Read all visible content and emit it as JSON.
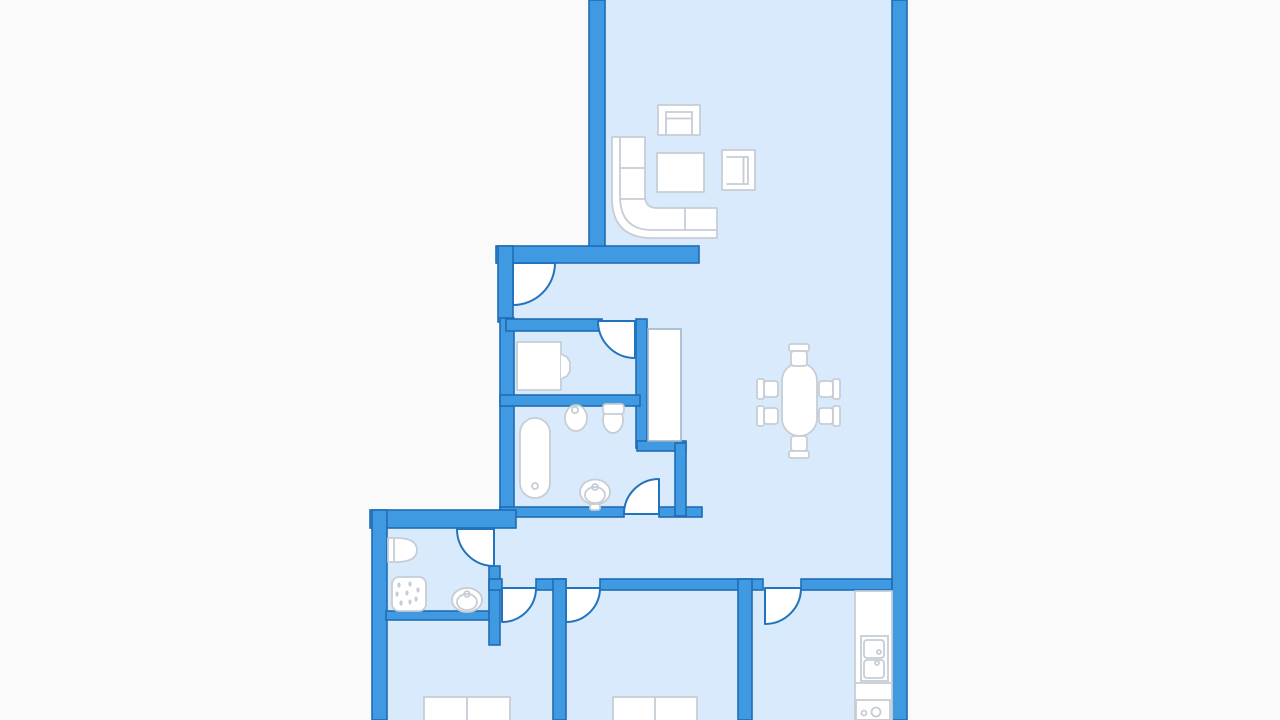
{
  "canvas": {
    "width": 1280,
    "height": 720
  },
  "colors": {
    "background": "#fafafa",
    "wall_fill": "#3f9ae2",
    "wall_stroke": "#1f6cb4",
    "door_stroke": "#2273bd",
    "floor": "#d8eafb",
    "furniture_fill": "#ffffff",
    "furniture_stroke": "#c6cdd5",
    "wardrobe_stroke": "#9db5c9"
  },
  "floors": [
    {
      "name": "living-dining-floor",
      "x": 602,
      "y": 0,
      "w": 292,
      "h": 588
    },
    {
      "name": "hall-bathroom-floor",
      "x": 505,
      "y": 250,
      "w": 150,
      "h": 338
    },
    {
      "name": "bedrooms-kitchen-floor",
      "x": 376,
      "y": 513,
      "w": 522,
      "h": 207
    }
  ],
  "walls": [
    {
      "name": "living-room-west-wall",
      "x": 589,
      "y": 0,
      "w": 16,
      "h": 262
    },
    {
      "name": "entry-north-wall",
      "x": 496,
      "y": 246,
      "w": 203,
      "h": 17
    },
    {
      "name": "entry-west-wall",
      "x": 498,
      "y": 246,
      "w": 15,
      "h": 76
    },
    {
      "name": "study-west-wall",
      "x": 500,
      "y": 318,
      "w": 14,
      "h": 194
    },
    {
      "name": "study-north-wall",
      "x": 506,
      "y": 319,
      "w": 96,
      "h": 12
    },
    {
      "name": "closet-west-wall",
      "x": 636,
      "y": 319,
      "w": 11,
      "h": 129
    },
    {
      "name": "study-bathroom-wall",
      "x": 500,
      "y": 395,
      "w": 140,
      "h": 11
    },
    {
      "name": "bathroom-south-wall-west",
      "x": 500,
      "y": 507,
      "w": 124,
      "h": 10
    },
    {
      "name": "bathroom-south-wall-east",
      "x": 659,
      "y": 507,
      "w": 43,
      "h": 10
    },
    {
      "name": "closet-south-wall",
      "x": 637,
      "y": 441,
      "w": 49,
      "h": 10
    },
    {
      "name": "closet-east-wall",
      "x": 675,
      "y": 443,
      "w": 11,
      "h": 73
    },
    {
      "name": "northwest-exterior-wall",
      "x": 370,
      "y": 510,
      "w": 146,
      "h": 18
    },
    {
      "name": "west-exterior-wall",
      "x": 372,
      "y": 510,
      "w": 15,
      "h": 210
    },
    {
      "name": "shower-room-south-wall",
      "x": 386,
      "y": 611,
      "w": 111,
      "h": 9
    },
    {
      "name": "shower-room-east-wall",
      "x": 489,
      "y": 566,
      "w": 11,
      "h": 79
    },
    {
      "name": "south-corridor-wall-a",
      "x": 489,
      "y": 579,
      "w": 13,
      "h": 11
    },
    {
      "name": "south-corridor-wall-b",
      "x": 536,
      "y": 579,
      "w": 30,
      "h": 11
    },
    {
      "name": "south-corridor-wall-c",
      "x": 600,
      "y": 579,
      "w": 163,
      "h": 11
    },
    {
      "name": "south-corridor-wall-d",
      "x": 801,
      "y": 579,
      "w": 91,
      "h": 11
    },
    {
      "name": "bedroom-divider-wall",
      "x": 553,
      "y": 579,
      "w": 13,
      "h": 141
    },
    {
      "name": "kitchen-divider-wall",
      "x": 738,
      "y": 579,
      "w": 14,
      "h": 141
    },
    {
      "name": "east-exterior-wall",
      "x": 892,
      "y": 0,
      "w": 15,
      "h": 720
    }
  ],
  "doors": [
    {
      "name": "entrance-door",
      "d": "M513,263 L555,263 A42,42 0 0 1 513,305 Z"
    },
    {
      "name": "study-door",
      "d": "M635,321 L635,358 A37,37 0 0 1 598,321 Z"
    },
    {
      "name": "bathroom-door",
      "d": "M659,514 L659,479 A35,35 0 0 0 624,514 Z"
    },
    {
      "name": "shower-door",
      "d": "M494,529 L494,566 A37,37 0 0 1 457,529 Z"
    },
    {
      "name": "bedroom1-door",
      "d": "M502,588 L536,588 A34,34 0 0 1 502,622 Z"
    },
    {
      "name": "bedroom2-door",
      "d": "M566,588 L600,588 A34,34 0 0 1 566,622 Z"
    },
    {
      "name": "kitchen-door",
      "d": "M765,588 L801,588 A36,36 0 0 1 765,624 Z"
    }
  ],
  "furniture": [
    {
      "name": "built-in-closet",
      "shapes": [
        {
          "k": "rect",
          "x": 648,
          "y": 329,
          "w": 33,
          "h": 112,
          "c": "ward"
        }
      ]
    },
    {
      "name": "armchair-top",
      "shapes": [
        {
          "k": "rect",
          "x": 658,
          "y": 105,
          "w": 42,
          "h": 30
        },
        {
          "k": "path",
          "d": "M666,135 L666,112 L692,112 L692,135",
          "c": "fline"
        },
        {
          "k": "line",
          "x1": 666,
          "y1": 118.5,
          "x2": 692,
          "y2": 118.5,
          "c": "fline"
        }
      ]
    },
    {
      "name": "corner-sofa",
      "shapes": [
        {
          "k": "path",
          "d": "M612,137 L645,137 L645,196 Q645,208 657,208 L717,208 L717,238 L652,238 Q612,238 612,198 Z"
        },
        {
          "k": "path",
          "d": "M620,137 L620,196 Q620,230 652,230 L717,230",
          "c": "fline"
        },
        {
          "k": "line",
          "x1": 620,
          "y1": 168,
          "x2": 645,
          "y2": 168,
          "c": "fline"
        },
        {
          "k": "line",
          "x1": 620,
          "y1": 199,
          "x2": 645,
          "y2": 199,
          "c": "fline"
        },
        {
          "k": "line",
          "x1": 685,
          "y1": 208,
          "x2": 685,
          "y2": 230,
          "c": "fline"
        }
      ]
    },
    {
      "name": "coffee-table",
      "shapes": [
        {
          "k": "rect",
          "x": 657,
          "y": 153,
          "w": 47,
          "h": 39
        }
      ]
    },
    {
      "name": "armchair-side",
      "shapes": [
        {
          "k": "rect",
          "x": 722,
          "y": 150,
          "w": 33,
          "h": 40
        },
        {
          "k": "path",
          "d": "M727,157 L748,157 L748,184 L727,184",
          "c": "fline"
        },
        {
          "k": "line",
          "x1": 743.5,
          "y1": 157,
          "x2": 743.5,
          "y2": 184,
          "c": "fline"
        }
      ]
    },
    {
      "name": "dining-table",
      "shapes": [
        {
          "k": "rect",
          "x": 782,
          "y": 363,
          "w": 35,
          "h": 73,
          "rx": 17.5
        }
      ]
    },
    {
      "name": "dining-chair-north",
      "shapes": [
        {
          "k": "rect",
          "x": 789,
          "y": 344,
          "w": 20,
          "h": 7,
          "rx": 2
        },
        {
          "k": "rect",
          "x": 791,
          "y": 351,
          "w": 16,
          "h": 15,
          "rx": 3
        }
      ]
    },
    {
      "name": "dining-chair-south",
      "shapes": [
        {
          "k": "rect",
          "x": 791,
          "y": 436,
          "w": 16,
          "h": 15,
          "rx": 3
        },
        {
          "k": "rect",
          "x": 789,
          "y": 451,
          "w": 20,
          "h": 7,
          "rx": 2
        }
      ]
    },
    {
      "name": "dining-chair-west-1",
      "shapes": [
        {
          "k": "rect",
          "x": 757,
          "y": 379,
          "w": 7,
          "h": 20,
          "rx": 2
        },
        {
          "k": "rect",
          "x": 764,
          "y": 381,
          "w": 14,
          "h": 16,
          "rx": 3
        }
      ]
    },
    {
      "name": "dining-chair-west-2",
      "shapes": [
        {
          "k": "rect",
          "x": 757,
          "y": 406,
          "w": 7,
          "h": 20,
          "rx": 2
        },
        {
          "k": "rect",
          "x": 764,
          "y": 408,
          "w": 14,
          "h": 16,
          "rx": 3
        }
      ]
    },
    {
      "name": "dining-chair-east-1",
      "shapes": [
        {
          "k": "rect",
          "x": 819,
          "y": 381,
          "w": 14,
          "h": 16,
          "rx": 3
        },
        {
          "k": "rect",
          "x": 833,
          "y": 379,
          "w": 7,
          "h": 20,
          "rx": 2
        }
      ]
    },
    {
      "name": "dining-chair-east-2",
      "shapes": [
        {
          "k": "rect",
          "x": 819,
          "y": 408,
          "w": 14,
          "h": 16,
          "rx": 3
        },
        {
          "k": "rect",
          "x": 833,
          "y": 406,
          "w": 7,
          "h": 20,
          "rx": 2
        }
      ]
    },
    {
      "name": "study-vanity-unit",
      "shapes": [
        {
          "k": "rect",
          "x": 517,
          "y": 342,
          "w": 44,
          "h": 48
        },
        {
          "k": "path",
          "d": "M561,354 L567,357 L570,362 L570,371 L567,376 L561,379"
        }
      ]
    },
    {
      "name": "bathtub",
      "shapes": [
        {
          "k": "rect",
          "x": 520,
          "y": 418,
          "w": 30,
          "h": 80,
          "rx": 15
        },
        {
          "k": "circle",
          "cx": 535,
          "cy": 486,
          "r": 3,
          "c": "fline"
        }
      ]
    },
    {
      "name": "bidet",
      "shapes": [
        {
          "k": "ellipse",
          "cx": 576,
          "cy": 418,
          "rx": 11,
          "ry": 13
        },
        {
          "k": "circle",
          "cx": 575,
          "cy": 410,
          "r": 3.2,
          "c": "fline"
        }
      ]
    },
    {
      "name": "toilet",
      "shapes": [
        {
          "k": "ellipse",
          "cx": 613,
          "cy": 420,
          "rx": 10,
          "ry": 13
        },
        {
          "k": "rect",
          "x": 603,
          "y": 404,
          "w": 21,
          "h": 10,
          "rx": 3
        }
      ]
    },
    {
      "name": "bathroom-washbasin",
      "shapes": [
        {
          "k": "ellipse",
          "cx": 595,
          "cy": 492,
          "rx": 15,
          "ry": 12.5
        },
        {
          "k": "ellipse",
          "cx": 595,
          "cy": 495,
          "rx": 10,
          "ry": 8,
          "c": "fline"
        },
        {
          "k": "circle",
          "cx": 595,
          "cy": 487,
          "r": 3,
          "c": "fline"
        },
        {
          "k": "rect",
          "x": 590,
          "y": 504,
          "w": 10,
          "h": 6,
          "rx": 2
        }
      ]
    },
    {
      "name": "shower-room-washbasin",
      "shapes": [
        {
          "k": "path",
          "d": "M388,538 L396,538 Q417,538 417,550 Q417,562 396,562 L388,562 Z"
        },
        {
          "k": "line",
          "x1": 394,
          "y1": 539,
          "x2": 394,
          "y2": 561,
          "c": "fline"
        }
      ]
    },
    {
      "name": "shower",
      "shapes": [
        {
          "k": "rect",
          "x": 392,
          "y": 577,
          "w": 34,
          "h": 34,
          "rx": 7
        },
        {
          "k": "ellipse",
          "cx": 399,
          "cy": 585,
          "rx": 1.6,
          "ry": 2.6,
          "c": "drop"
        },
        {
          "k": "ellipse",
          "cx": 410,
          "cy": 584,
          "rx": 1.6,
          "ry": 2.6,
          "c": "drop"
        },
        {
          "k": "ellipse",
          "cx": 418,
          "cy": 590,
          "rx": 1.6,
          "ry": 2.6,
          "c": "drop"
        },
        {
          "k": "ellipse",
          "cx": 397,
          "cy": 594,
          "rx": 1.6,
          "ry": 2.6,
          "c": "drop"
        },
        {
          "k": "ellipse",
          "cx": 407,
          "cy": 593,
          "rx": 1.6,
          "ry": 2.6,
          "c": "drop"
        },
        {
          "k": "ellipse",
          "cx": 416,
          "cy": 599,
          "rx": 1.6,
          "ry": 2.6,
          "c": "drop"
        },
        {
          "k": "ellipse",
          "cx": 401,
          "cy": 603,
          "rx": 1.6,
          "ry": 2.6,
          "c": "drop"
        },
        {
          "k": "ellipse",
          "cx": 410,
          "cy": 602,
          "rx": 1.6,
          "ry": 2.6,
          "c": "drop"
        }
      ]
    },
    {
      "name": "shower-room-toilet",
      "shapes": [
        {
          "k": "ellipse",
          "cx": 467,
          "cy": 600,
          "rx": 15,
          "ry": 12
        },
        {
          "k": "ellipse",
          "cx": 467,
          "cy": 602,
          "rx": 10,
          "ry": 8,
          "c": "fline"
        },
        {
          "k": "circle",
          "cx": 467,
          "cy": 594,
          "r": 2.8,
          "c": "fline"
        }
      ]
    },
    {
      "name": "bed-1",
      "shapes": [
        {
          "k": "rect",
          "x": 424,
          "y": 697,
          "w": 86,
          "h": 27
        },
        {
          "k": "line",
          "x1": 467,
          "y1": 697,
          "x2": 467,
          "y2": 724,
          "c": "fline"
        }
      ]
    },
    {
      "name": "bed-2",
      "shapes": [
        {
          "k": "rect",
          "x": 613,
          "y": 697,
          "w": 84,
          "h": 27
        },
        {
          "k": "line",
          "x1": 655,
          "y1": 697,
          "x2": 655,
          "y2": 724,
          "c": "fline"
        }
      ]
    },
    {
      "name": "kitchen-counter",
      "shapes": [
        {
          "k": "rect",
          "x": 855,
          "y": 591,
          "w": 37,
          "h": 129
        },
        {
          "k": "line",
          "x1": 855,
          "y1": 683,
          "x2": 892,
          "y2": 683,
          "c": "fline"
        }
      ]
    },
    {
      "name": "kitchen-sink",
      "shapes": [
        {
          "k": "rect",
          "x": 861,
          "y": 636,
          "w": 27,
          "h": 45,
          "c": "fline"
        },
        {
          "k": "rect",
          "x": 864,
          "y": 640,
          "w": 20,
          "h": 18,
          "rx": 3,
          "c": "fline"
        },
        {
          "k": "rect",
          "x": 864,
          "y": 660,
          "w": 20,
          "h": 18,
          "rx": 3,
          "c": "fline"
        },
        {
          "k": "circle",
          "cx": 879,
          "cy": 652,
          "r": 2,
          "c": "fline"
        },
        {
          "k": "circle",
          "cx": 877,
          "cy": 663,
          "r": 2,
          "c": "fline"
        }
      ]
    },
    {
      "name": "stove",
      "shapes": [
        {
          "k": "rect",
          "x": 856,
          "y": 700,
          "w": 34,
          "h": 20,
          "c": "fline"
        },
        {
          "k": "circle",
          "cx": 864,
          "cy": 713,
          "r": 2.5,
          "c": "fline"
        },
        {
          "k": "circle",
          "cx": 876,
          "cy": 712,
          "r": 4.5,
          "c": "fline"
        }
      ]
    }
  ]
}
